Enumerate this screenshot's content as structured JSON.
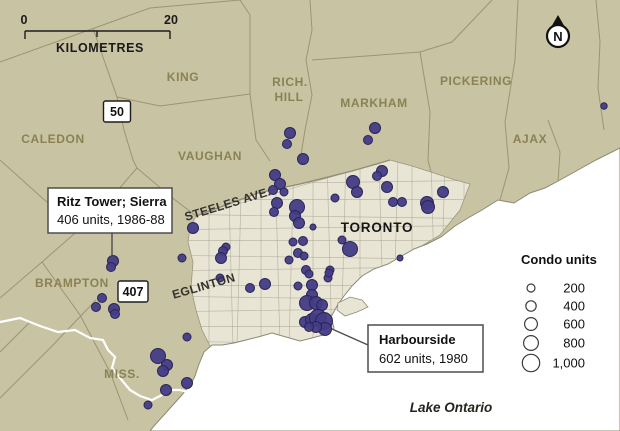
{
  "scalebar": {
    "start": "0",
    "end": "20",
    "unit": "KILOMETRES"
  },
  "north_label": "N",
  "highways": {
    "h50": "50",
    "h407": "407"
  },
  "regions": {
    "caledon": "CALEDON",
    "king": "KING",
    "rich1": "RICH.",
    "rich2": "HILL",
    "markham": "MARKHAM",
    "pickering": "PICKERING",
    "ajax": "AJAX",
    "vaughan": "VAUGHAN",
    "brampton": "BRAMPTON",
    "mississauga": "MISS.",
    "toronto": "TORONTO"
  },
  "streets": {
    "steeles": "STEELES AVE.",
    "eglinton": "EGLINTON"
  },
  "water": {
    "lake": "Lake Ontario"
  },
  "callouts": {
    "ritz": {
      "title": "Ritz Tower; Sierra",
      "detail": "406 units, 1986-88"
    },
    "harbourside": {
      "title": "Harbourside",
      "detail": "602 units, 1980"
    }
  },
  "legend": {
    "title": "Condo units",
    "items": [
      {
        "label": "200",
        "r": 4
      },
      {
        "label": "400",
        "r": 5.2
      },
      {
        "label": "600",
        "r": 6.4
      },
      {
        "label": "800",
        "r": 7.4
      },
      {
        "label": "1,000",
        "r": 8.7
      }
    ]
  },
  "colors": {
    "land": "#c8c3a2",
    "urban": "#e9e5d4",
    "lake": "#ffffff",
    "dot": "#453c86",
    "dot_stroke": "#2a2556",
    "boundary": "#97906c",
    "label_olive": "#8a8254"
  },
  "chart_data": {
    "type": "scatter",
    "title": "Condo developments in the Greater Toronto Area, symbol size = number of units",
    "legend_title": "Condo units",
    "legend_sizes": [
      200,
      400,
      600,
      800,
      1000
    ],
    "annotations": [
      {
        "label": "Ritz Tower; Sierra",
        "units": 406,
        "years": "1986-88",
        "x": 113,
        "y": 261
      },
      {
        "label": "Harbourside",
        "units": 602,
        "years": "1980",
        "x": 330,
        "y": 328
      }
    ],
    "points": [
      [
        604,
        106,
        3.2
      ],
      [
        290,
        133,
        5.5
      ],
      [
        287,
        144,
        4.5
      ],
      [
        303,
        159,
        5.5
      ],
      [
        375,
        128,
        5.5
      ],
      [
        368,
        140,
        4.5
      ],
      [
        275,
        175,
        5.5
      ],
      [
        280,
        184,
        5.5
      ],
      [
        273,
        190,
        4.5
      ],
      [
        284,
        192,
        4
      ],
      [
        353,
        182,
        6.5
      ],
      [
        357,
        192,
        5.5
      ],
      [
        335,
        198,
        4
      ],
      [
        277,
        203,
        5.5
      ],
      [
        274,
        212,
        4.5
      ],
      [
        297,
        207,
        7.5
      ],
      [
        295,
        216,
        5.5
      ],
      [
        299,
        223,
        5.5
      ],
      [
        193,
        228,
        5.5
      ],
      [
        382,
        171,
        5.5
      ],
      [
        377,
        176,
        4.5
      ],
      [
        387,
        187,
        5.5
      ],
      [
        393,
        202,
        4.5
      ],
      [
        402,
        202,
        4.5
      ],
      [
        427,
        203,
        6.5
      ],
      [
        443,
        192,
        5.5
      ],
      [
        428,
        207,
        6.5
      ],
      [
        313,
        227,
        3
      ],
      [
        342,
        240,
        4
      ],
      [
        350,
        249,
        7.5
      ],
      [
        400,
        258,
        3
      ],
      [
        293,
        242,
        4
      ],
      [
        303,
        241,
        4.5
      ],
      [
        298,
        253,
        4.5
      ],
      [
        304,
        256,
        4
      ],
      [
        289,
        260,
        4
      ],
      [
        306,
        270,
        4.5
      ],
      [
        226,
        247,
        4
      ],
      [
        223,
        251,
        4.5
      ],
      [
        221,
        258,
        5.5
      ],
      [
        182,
        258,
        4
      ],
      [
        220,
        278,
        4
      ],
      [
        250,
        288,
        4.5
      ],
      [
        265,
        284,
        5.5
      ],
      [
        330,
        270,
        4
      ],
      [
        328,
        278,
        4
      ],
      [
        309,
        274,
        4
      ],
      [
        329,
        273,
        4
      ],
      [
        298,
        286,
        4
      ],
      [
        312,
        285,
        5.5
      ],
      [
        312,
        295,
        5.5
      ],
      [
        307,
        303,
        7.5
      ],
      [
        316,
        303,
        6.5
      ],
      [
        322,
        305,
        5.5
      ],
      [
        305,
        322,
        5.5
      ],
      [
        312,
        320,
        6.5
      ],
      [
        318,
        318,
        8.5
      ],
      [
        324,
        321,
        8.5
      ],
      [
        325,
        329,
        6.5
      ],
      [
        316,
        327,
        5.5
      ],
      [
        309,
        327,
        4.5
      ],
      [
        113,
        261,
        5.5
      ],
      [
        111,
        267,
        4.5
      ],
      [
        102,
        298,
        4.5
      ],
      [
        96,
        307,
        4.5
      ],
      [
        114,
        309,
        5.5
      ],
      [
        115,
        314,
        4.5
      ],
      [
        187,
        337,
        4
      ],
      [
        158,
        356,
        7.5
      ],
      [
        167,
        365,
        5.5
      ],
      [
        163,
        371,
        5.5
      ],
      [
        187,
        383,
        5.5
      ],
      [
        166,
        390,
        5.5
      ],
      [
        148,
        405,
        4
      ]
    ]
  }
}
